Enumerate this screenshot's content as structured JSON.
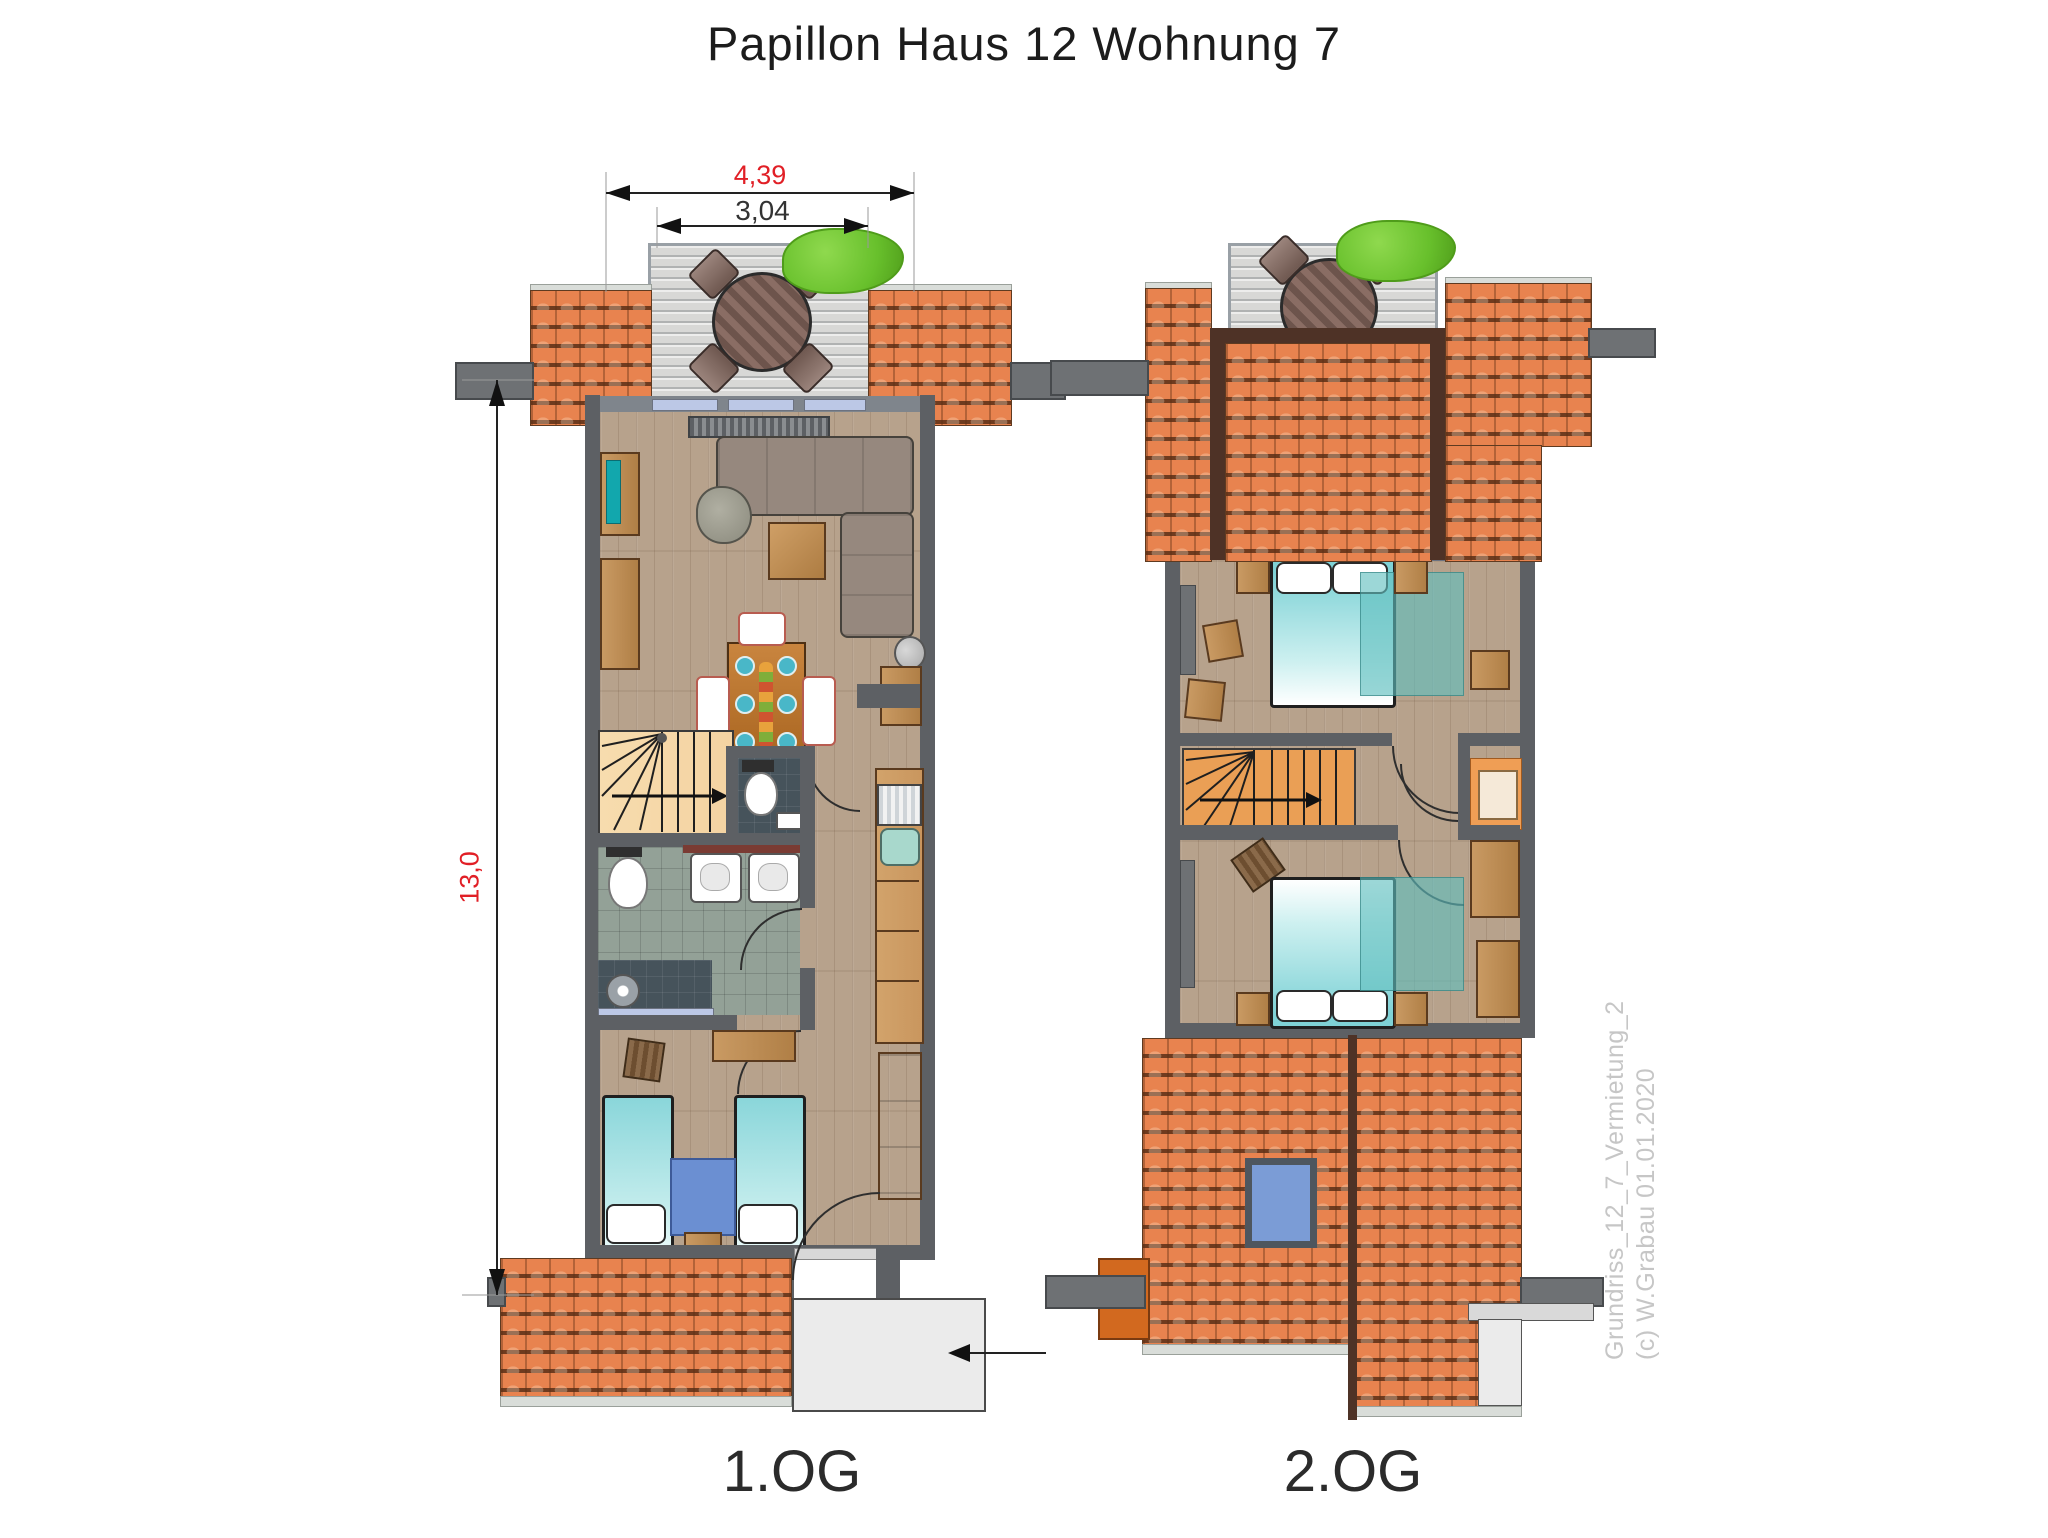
{
  "title": "Papillon Haus 12 Wohnung 7",
  "floor_labels": {
    "first": "1.OG",
    "second": "2.OG"
  },
  "dimensions": {
    "outer_width_m": "4,39",
    "inner_width_m": "3,04",
    "total_height_m": "13,0"
  },
  "watermark": {
    "line1": "Grundriss_12_7_Vermietung_2",
    "line2": "(c) W.Grabau 01.01.2020"
  },
  "colors": {
    "roof_tile": "#e8834f",
    "ridge": "#4e3226",
    "wall": "#5d6064",
    "wood_floor": "#b7a28c",
    "deck": "#d8d8d6",
    "bush": "#68c02c",
    "bed_teal": "#7fd2d6",
    "rug_blue": "#6b8fd2",
    "skylight": "#7b9cd6",
    "stairs_light": "#f4d3a2",
    "stairs_orange": "#ea9f55",
    "bath_tile": "#93a197",
    "dark_tile": "#46535b",
    "kitchen_wood": "#c9965e",
    "sofa": "#96887e",
    "dining_wood": "#b5793e",
    "chimney": "#d2691f",
    "glass": "#bcc8e6",
    "dim_red": "#e11f26",
    "watermark_gray": "#c6c6c6"
  }
}
